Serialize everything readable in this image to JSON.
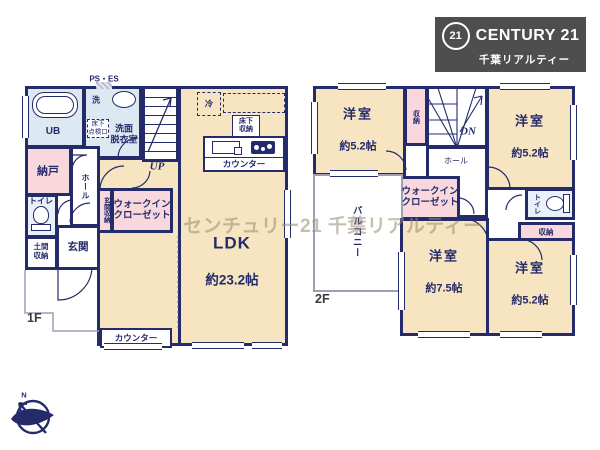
{
  "logo": {
    "badge": "21",
    "brand": "CENTURY 21",
    "subtitle": "千葉リアルティー"
  },
  "watermark": "センチュリー21 千葉リアルティー",
  "compass": {
    "n": "N"
  },
  "colors": {
    "wall": "#242b6b",
    "room_cream": "#f6e5c0",
    "closet_pink": "#f8d8dc",
    "wet_blue": "#dde9f2",
    "logo_bg": "#4e4e4e"
  },
  "floor1": {
    "label": "1F",
    "ps_es": "PS・ES",
    "up": "UP",
    "ub": "UB",
    "wash": "洗",
    "senmen": "洗面\n脱衣室",
    "inspection": "床下\n点検口",
    "nando": "納戸",
    "hall": "ホール",
    "toilet": "トイレ",
    "doma": "土間\n収納",
    "genkan": "玄関",
    "genkan_shuno": "玄関収納",
    "wic": "ウォークイン\nクローゼット",
    "fridge": "冷",
    "underfloor": "床下\n収納",
    "kitchen_counter": "カウンター",
    "ldk": "LDK",
    "ldk_size": "約23.2帖",
    "counter": "カウンター"
  },
  "floor2": {
    "label": "2F",
    "dn": "DN",
    "hall": "ホール",
    "room_tl": {
      "name": "洋室",
      "size": "約5.2帖"
    },
    "closet_top": "収納",
    "room_tr": {
      "name": "洋室",
      "size": "約5.2帖"
    },
    "wic": "ウォークイン\nクローゼット",
    "toilet": "トイレ",
    "closet_right": "収納",
    "balcony": "バルコニー",
    "room_b": {
      "name": "洋室",
      "size": "約7.5帖"
    },
    "room_br": {
      "name": "洋室",
      "size": "約5.2帖"
    }
  }
}
